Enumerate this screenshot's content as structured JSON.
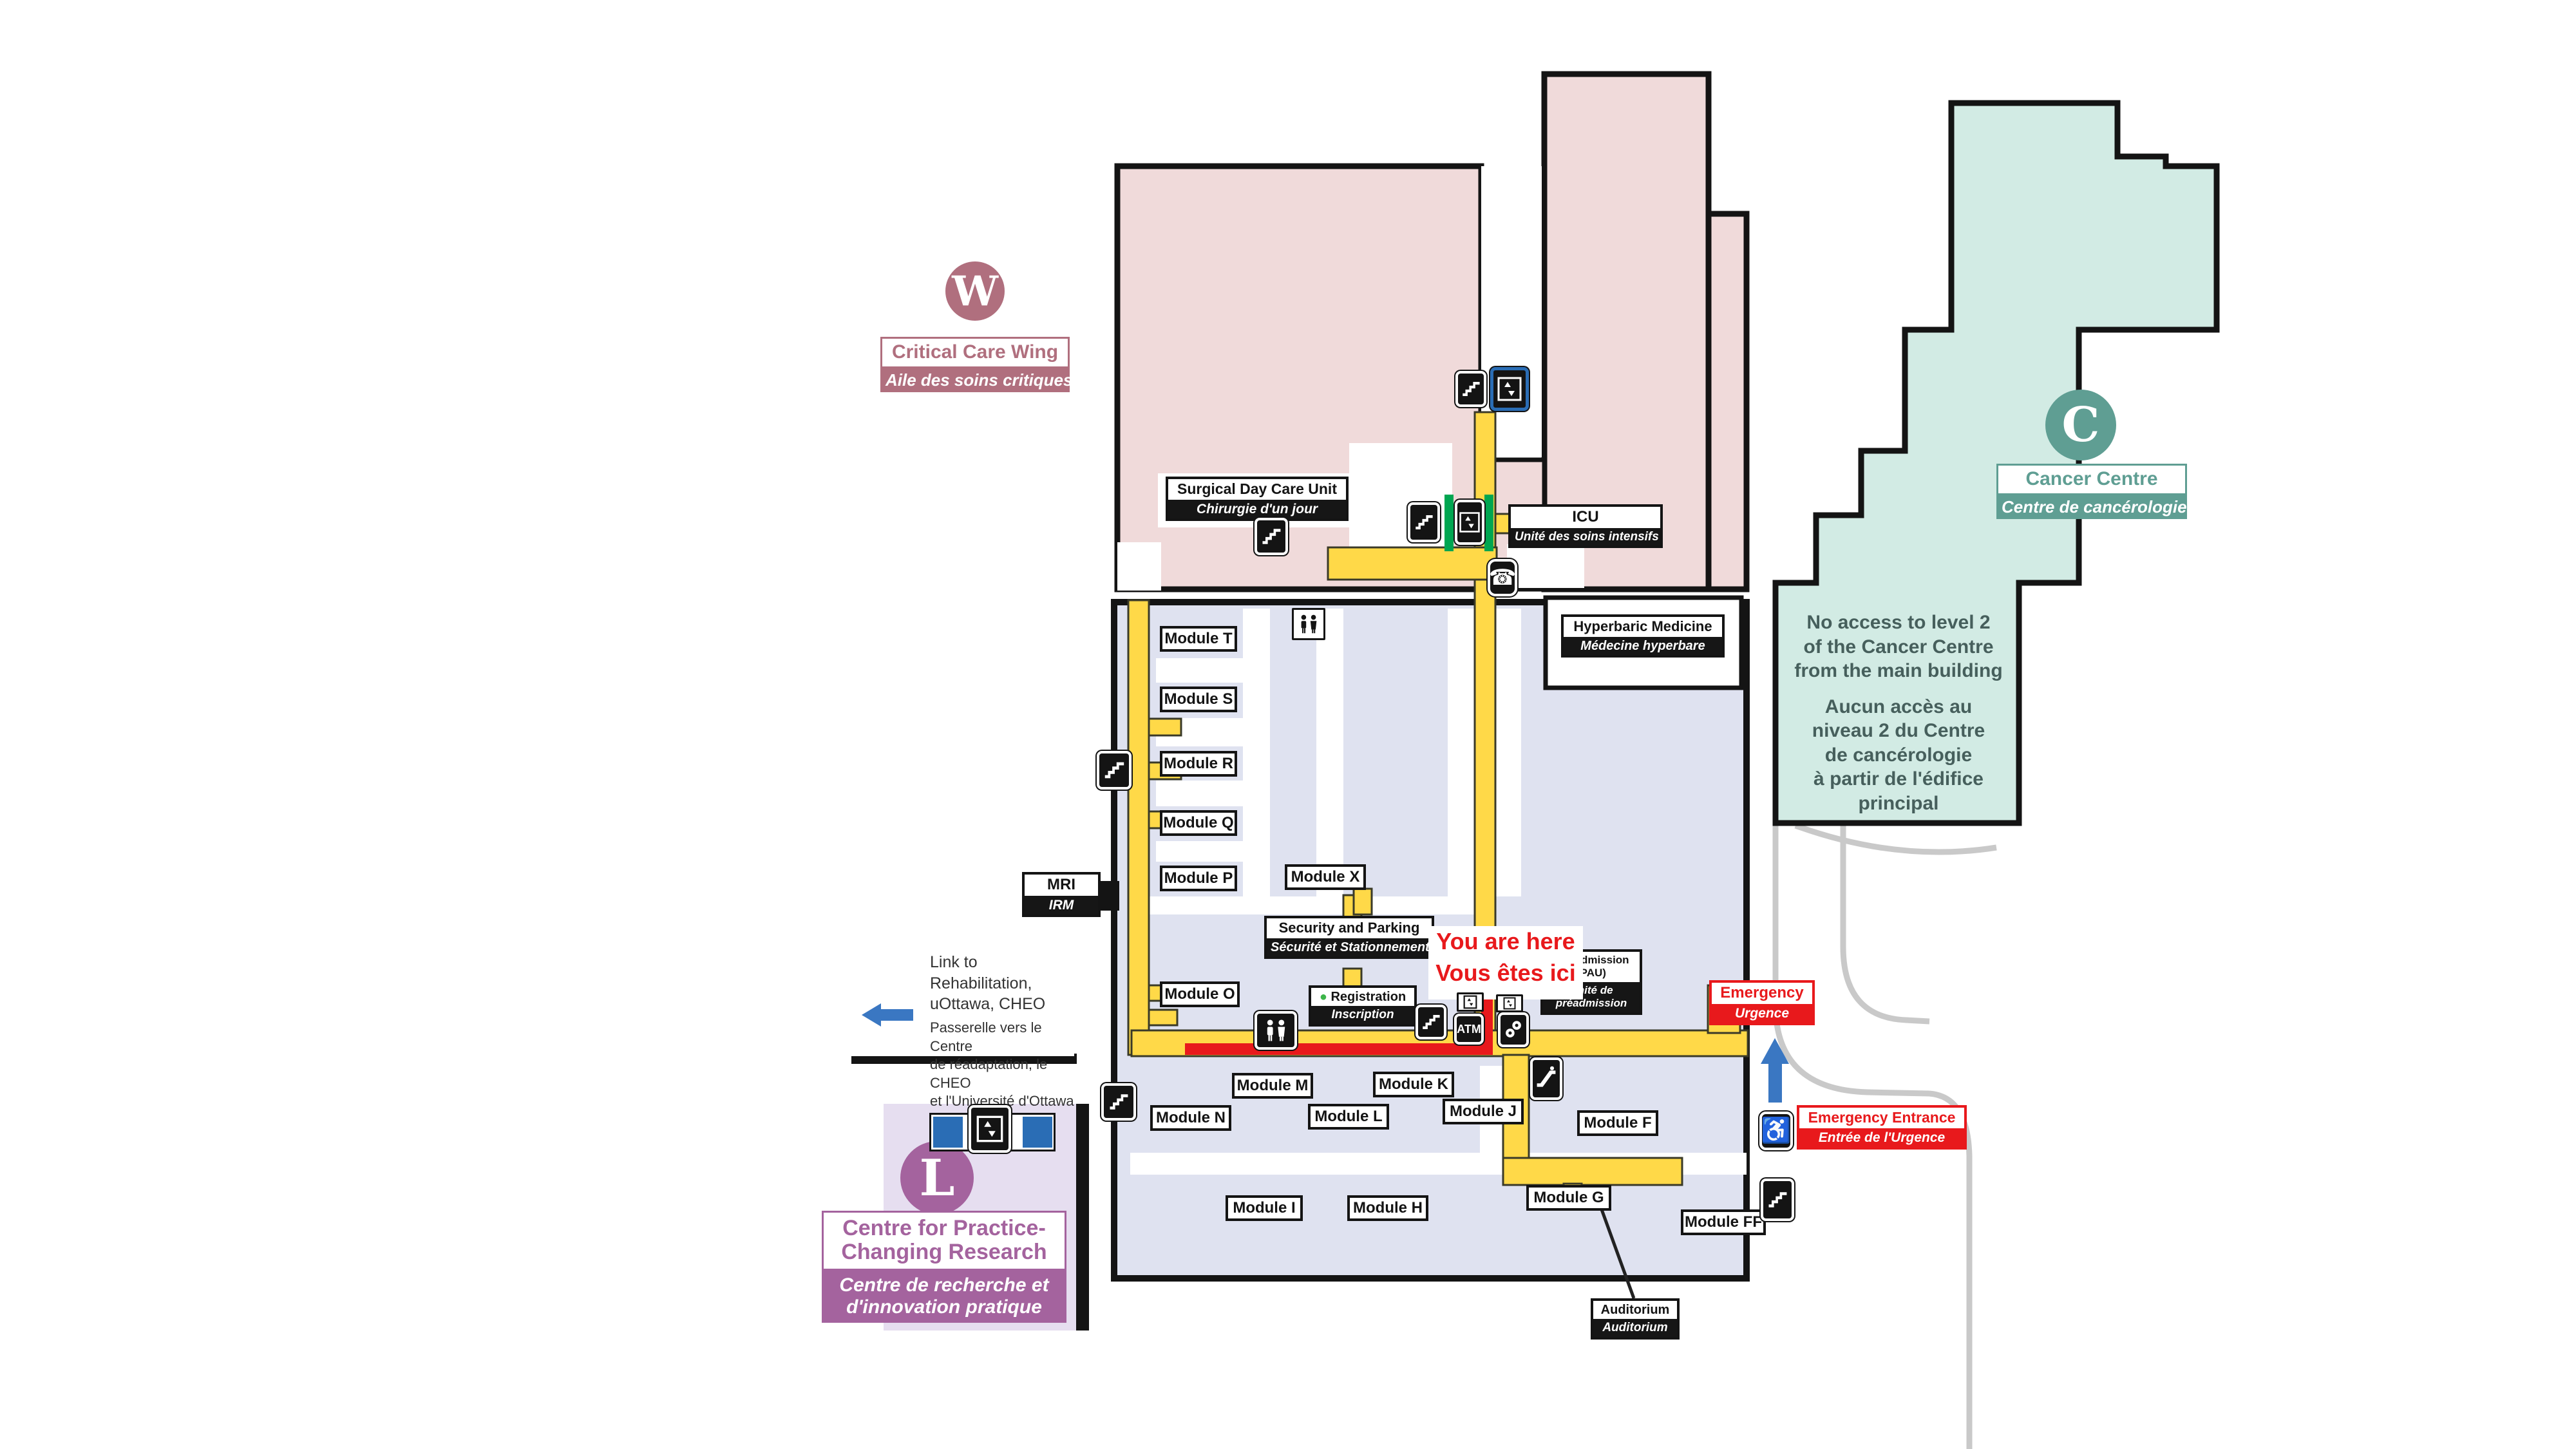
{
  "title": "Hospital main level floor plan",
  "wings": {
    "w": {
      "letter": "W",
      "line1": "Critical Care Wing",
      "line2": "Aile des soins critiques"
    },
    "c": {
      "letter": "C",
      "line1": "Cancer Centre",
      "line2": "Centre de cancérologie"
    },
    "l": {
      "letter": "L",
      "line1a": "Centre for Practice-",
      "line1b": "Changing Research",
      "line2a": "Centre de recherche et",
      "line2b": "d'innovation pratique"
    }
  },
  "rooms": {
    "surgical": {
      "en": "Surgical Day Care Unit",
      "fr": "Chirurgie d'un jour"
    },
    "icu": {
      "en": "ICU",
      "fr": "Unité des soins intensifs"
    },
    "hyperbaric": {
      "en": "Hyperbaric Medicine",
      "fr": "Médecine hyperbare"
    },
    "mri": {
      "en": "MRI",
      "fr": "IRM"
    },
    "security": {
      "en": "Security and Parking",
      "fr": "Sécurité et Stationnement"
    },
    "registration": {
      "en": "Registration",
      "fr": "Inscription"
    },
    "admission": {
      "en1": "Pre-admission",
      "en2": "(PAU)",
      "fr1": "Unité de",
      "fr2": "préadmission"
    },
    "emergency": {
      "en": "Emergency",
      "fr": "Urgence"
    },
    "emergency_entrance": {
      "en": "Emergency Entrance",
      "fr": "Entrée de l'Urgence"
    },
    "auditorium": {
      "en": "Auditorium",
      "fr": "Auditorium"
    },
    "atm": "ATM"
  },
  "modules": {
    "t": "Module T",
    "s": "Module S",
    "r": "Module R",
    "q": "Module Q",
    "p": "Module P",
    "x": "Module X",
    "o": "Module O",
    "m": "Module M",
    "k": "Module K",
    "n": "Module N",
    "l": "Module L",
    "j": "Module J",
    "f": "Module F",
    "i": "Module I",
    "h": "Module H",
    "g": "Module G",
    "ff": "Module FF"
  },
  "you_are_here": {
    "en": "You are here",
    "fr": "Vous êtes ici"
  },
  "no_access": {
    "en1": "No access to level 2",
    "en2": "of the Cancer Centre",
    "en3": "from the main building",
    "fr1": "Aucun accès au",
    "fr2": "niveau 2 du Centre",
    "fr3": "de cancérologie",
    "fr4": "à partir de l'édifice",
    "fr5": "principal"
  },
  "link_note": {
    "en1": "Link to",
    "en2": "Rehabilitation,",
    "en3": "uOttawa, CHEO",
    "fr1": "Passerelle vers le Centre",
    "fr2": "de réadaptation, le CHEO",
    "fr3": "et l'Université d'Ottawa"
  },
  "icons": {
    "stairs-icon": "white staircase steps on black square",
    "elevator-icon": "elevator car with figures, white on black square",
    "elevator-icon-small": "small elevator pictogram in white box",
    "washroom-icon": "two person figures pictogram",
    "phone-icon": "☎",
    "wheelchair-icon": "♿",
    "escalator-icon": "diagonal escalator steps on black square",
    "atm-icon": "ATM",
    "keys-icon": "two round key heads, white on black square",
    "entrance-up-arrow": "▲",
    "link-left-arrow": "◀",
    "registration-dot": "●"
  },
  "colors": {
    "critical_care": "#b06f7e",
    "cancer": "#5f9e93",
    "research": "#a4639e",
    "corridor_yellow": "#ffd948",
    "pink_fill": "#f0dada",
    "main_fill": "#dfe2f0",
    "teal_fill": "#d2ebe4",
    "lavender_fill": "#e6def0",
    "path_red": "#e8191c",
    "arrow_blue": "#3a77c2",
    "green_highlight": "#00a651",
    "road_gray": "#c9c9c9"
  }
}
